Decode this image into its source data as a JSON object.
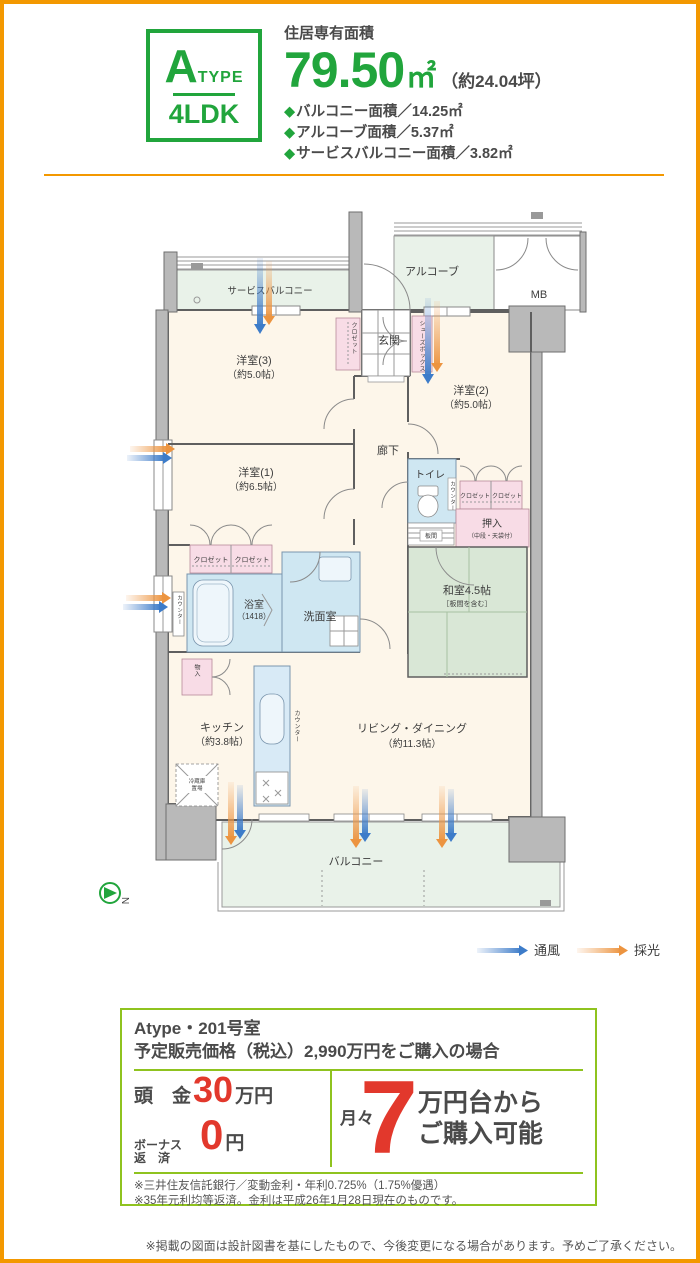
{
  "header": {
    "type_letter": "A",
    "type_word": "TYPE",
    "layout": "4LDK",
    "area_label": "住居専有面積",
    "area_value": "79.50",
    "area_unit": "㎡",
    "area_tsubo": "（約24.04坪）",
    "bullet_marker": "◆",
    "bullet_1": "バルコニー面積／14.25㎡",
    "bullet_2": "アルコーブ面積／5.37㎡",
    "bullet_3": "サービスバルコニー面積／3.82㎡"
  },
  "floorplan": {
    "service_balcony": "サービスバルコニー",
    "alcove": "アルコーブ",
    "mb": "MB",
    "entrance": "玄関",
    "shoes_box": "シューズボックス",
    "closet": "クロゼット",
    "room3_name": "洋室(3)",
    "room3_size": "（約5.0帖）",
    "room2_name": "洋室(2)",
    "room2_size": "（約5.0帖）",
    "room1_name": "洋室(1)",
    "room1_size": "（約6.5帖）",
    "hallway": "廊下",
    "toilet": "トイレ",
    "counter": "カウンター",
    "oshiire_name": "押入",
    "oshiire_note": "（中段・天袋付）",
    "itama": "板間",
    "washitsu_name": "和室4.5帖",
    "washitsu_note": "［板間を含む］",
    "linen": "リネン庫",
    "bath_name": "浴室",
    "bath_size": "（1418）",
    "washroom": "洗面室",
    "storage": "物入",
    "kitchen_name": "キッチン",
    "kitchen_size": "（約3.8帖）",
    "fridge_l1": "冷蔵庫",
    "fridge_l2": "置場",
    "living_name": "リビング・ダイニング",
    "living_size": "（約11.3帖）",
    "balcony": "バルコニー",
    "north_mark": "N",
    "legend_wind": "通風",
    "legend_light": "採光"
  },
  "pricing": {
    "room_line": "Atype・201号室",
    "condition_line": "予定販売価格（税込）2,990万円をご購入の場合",
    "down_label": "頭　金",
    "down_value": "30",
    "down_unit": "万円",
    "bonus_label_1": "ボーナス",
    "bonus_label_2": "返　済",
    "bonus_value": "0",
    "bonus_unit": "円",
    "monthly_label": "月々",
    "monthly_value": "7",
    "monthly_text_1": "万円台から",
    "monthly_text_2": "ご購入可能",
    "note_1": "※三井住友信託銀行／変動金利・年利0.725%（1.75%優遇）",
    "note_2": "※35年元利均等返済。金利は平成26年1月28日現在のものです。"
  },
  "footer": {
    "disclaimer": "※掲載の図面は設計図書を基にしたもので、今後変更になる場合があります。予めご了承ください。"
  },
  "colors": {
    "brand_green": "#21A53C",
    "accent_orange": "#F39800",
    "price_red": "#E2382C",
    "rule_green": "#8FC31F"
  }
}
